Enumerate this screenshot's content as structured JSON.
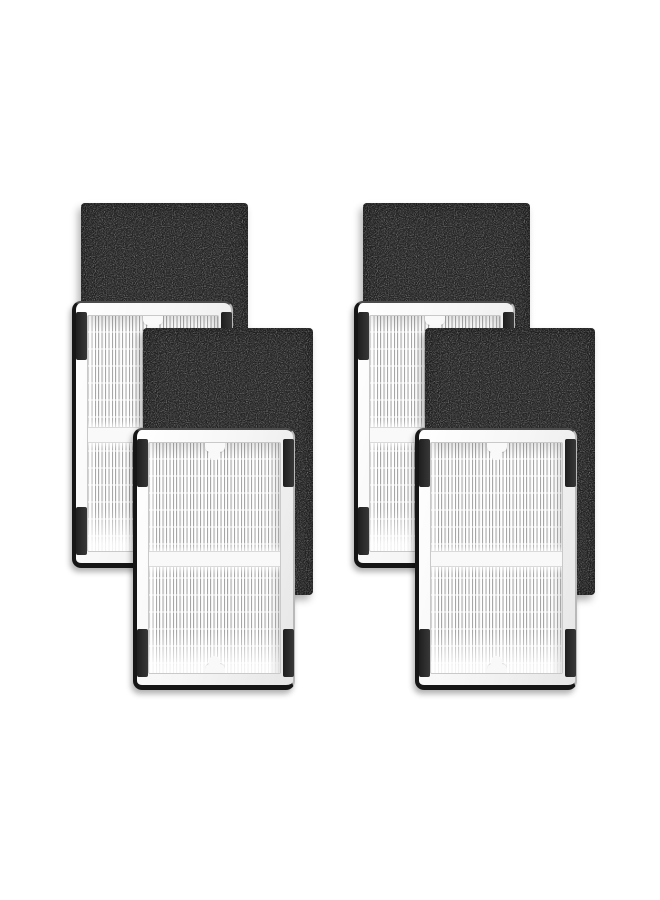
{
  "scene": {
    "kind": "product-photo",
    "visible_text": [],
    "subject": "Replacement air purifier filter kit: 4 white pleated HEPA filter panels paired with 4 black activated carbon pre-filter sheets, shown as two overlapping diagonal pairs in two columns on a white background",
    "sets": [
      {
        "id": "left",
        "panels": [
          {
            "type": "carbon",
            "depth": "back",
            "label": "activated carbon pre-filter sheet"
          },
          {
            "type": "hepa",
            "depth": "back",
            "label": "pleated HEPA filter panel"
          },
          {
            "type": "carbon",
            "depth": "front",
            "label": "activated carbon pre-filter sheet"
          },
          {
            "type": "hepa",
            "depth": "front",
            "label": "pleated HEPA filter panel"
          }
        ]
      },
      {
        "id": "right",
        "panels": [
          {
            "type": "carbon",
            "depth": "back",
            "label": "activated carbon pre-filter sheet"
          },
          {
            "type": "hepa",
            "depth": "back",
            "label": "pleated HEPA filter panel"
          },
          {
            "type": "carbon",
            "depth": "front",
            "label": "activated carbon pre-filter sheet"
          },
          {
            "type": "hepa",
            "depth": "front",
            "label": "pleated HEPA filter panel"
          }
        ]
      }
    ]
  },
  "colors": {
    "page_bg": "#ffffff",
    "carbon_base": "#232323",
    "frame_white": "#f9f9f9",
    "frame_shade": "#e6e6e6",
    "pleat_line": "#a6a6a6",
    "pleat_gap": "#ffffff",
    "edge_dark": "#161616",
    "tab_black": "#1f1f1f",
    "window_border": "#c9c9c9",
    "band_line": "#dadada"
  }
}
